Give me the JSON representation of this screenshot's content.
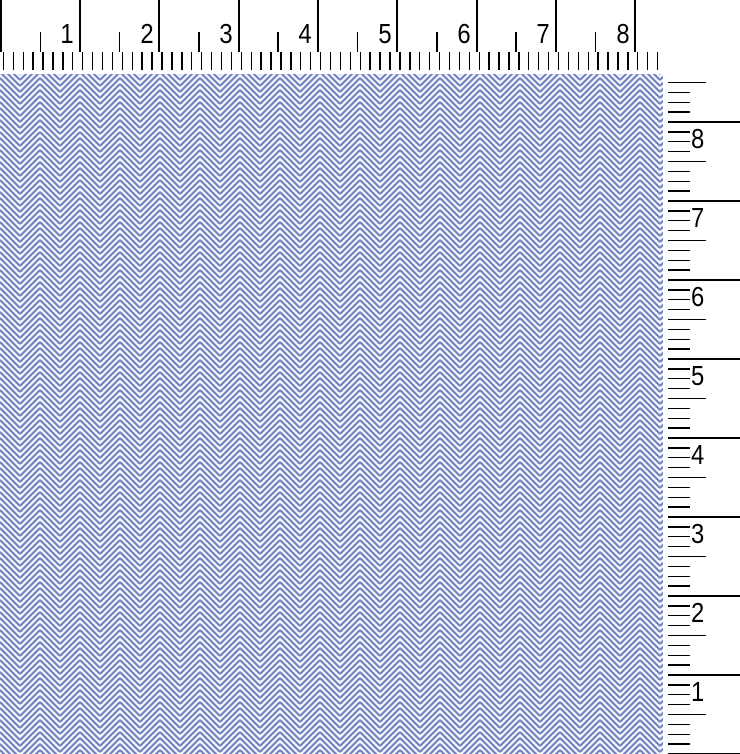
{
  "view": {
    "title": "fabric swatch with measuring rulers",
    "background": "#ffffff",
    "tick_color": "#000000"
  },
  "ruler_top": {
    "orientation": "horizontal",
    "unit": "inches",
    "labels": [
      "1",
      "2",
      "3",
      "4",
      "5",
      "6",
      "7",
      "8"
    ],
    "px_per_inch": 79.3,
    "subdivisions_per_inch": 8
  },
  "ruler_right": {
    "orientation": "vertical",
    "unit": "inches",
    "labels": [
      "8",
      "7",
      "6",
      "5",
      "4",
      "3",
      "2",
      "1"
    ],
    "px_per_inch": 79,
    "subdivisions_per_inch": 8
  },
  "fabric": {
    "pattern": "herringbone twill",
    "colors": {
      "yarn_blue": "#7282c1",
      "ground_light": "#eef1f8",
      "highlight": "#ffffff"
    },
    "chevron_column_width_px": 20,
    "stripe_spacing_px": 6
  }
}
